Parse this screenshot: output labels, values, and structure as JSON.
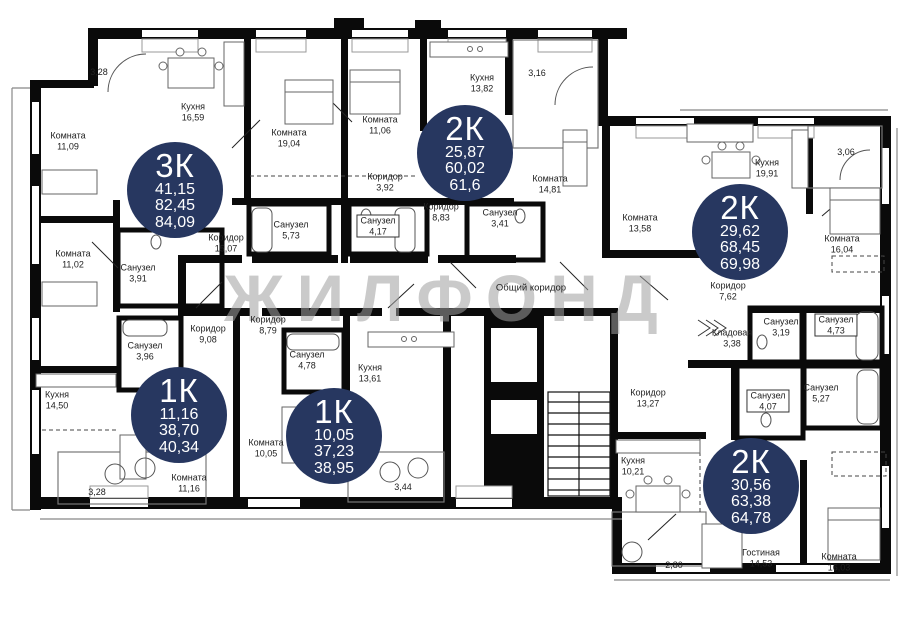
{
  "watermark": {
    "text": "ЖИЛФОНД"
  },
  "corridor_label": "Общий коридор",
  "badges": [
    {
      "type": "3К",
      "values": [
        "41,15",
        "82,45",
        "84,09"
      ]
    },
    {
      "type": "2К",
      "values": [
        "25,87",
        "60,02",
        "61,6"
      ]
    },
    {
      "type": "2К",
      "values": [
        "29,62",
        "68,45",
        "69,98"
      ]
    },
    {
      "type": "1К",
      "values": [
        "11,16",
        "38,70",
        "40,34"
      ]
    },
    {
      "type": "1К",
      "values": [
        "10,05",
        "37,23",
        "38,95"
      ]
    },
    {
      "type": "2К",
      "values": [
        "30,56",
        "63,38",
        "64,78"
      ]
    }
  ],
  "rooms": [
    {
      "name": "Комната",
      "area": "11,09"
    },
    {
      "name": "Кухня",
      "area": "16,59"
    },
    {
      "name": "Комната",
      "area": "19,04"
    },
    {
      "name": "Комната",
      "area": "11,06"
    },
    {
      "name": "Коридор",
      "area": "3,92"
    },
    {
      "name": "Кухня",
      "area": "13,82"
    },
    {
      "name": "Комната",
      "area": "14,81"
    },
    {
      "name": "Коридор",
      "area": "8,83"
    },
    {
      "name": "Санузел",
      "area": "5,73"
    },
    {
      "name": "Санузел",
      "area": "4,17"
    },
    {
      "name": "Санузел",
      "area": "3,41"
    },
    {
      "name": "Комната",
      "area": "13,58"
    },
    {
      "name": "Кухня",
      "area": "19,91"
    },
    {
      "name": "Комната",
      "area": "16,04"
    },
    {
      "name": "Коридор",
      "area": "7,62"
    },
    {
      "name": "Комната",
      "area": "11,02"
    },
    {
      "name": "Санузел",
      "area": "3,91"
    },
    {
      "name": "Коридор",
      "area": "15,07"
    },
    {
      "name": "Санузел",
      "area": "3,96"
    },
    {
      "name": "Коридор",
      "area": "9,08"
    },
    {
      "name": "Кухня",
      "area": "14,50"
    },
    {
      "name": "Коридор",
      "area": "8,79"
    },
    {
      "name": "Санузел",
      "area": "4,78"
    },
    {
      "name": "Кухня",
      "area": "13,61"
    },
    {
      "name": "Комната",
      "area": "10,05"
    },
    {
      "name": "Комната",
      "area": "11,16"
    },
    {
      "name": "Кладовая",
      "area": "3,38"
    },
    {
      "name": "Санузел",
      "area": "3,19"
    },
    {
      "name": "Санузел",
      "area": "4,73"
    },
    {
      "name": "Санузел",
      "area": "4,07"
    },
    {
      "name": "Санузел",
      "area": "5,27"
    },
    {
      "name": "Коридор",
      "area": "13,27"
    },
    {
      "name": "Кухня",
      "area": "10,21"
    },
    {
      "name": "Гостиная",
      "area": "14,53"
    },
    {
      "name": "Комната",
      "area": "16,03"
    }
  ],
  "balconies": [
    {
      "area": "3,28"
    },
    {
      "area": "3,16"
    },
    {
      "area": "3,06"
    },
    {
      "area": "3,28"
    },
    {
      "area": "3,44"
    },
    {
      "area": "2,80"
    }
  ],
  "colors": {
    "badge_bg": "#273760",
    "wall": "#0a0a0a",
    "watermark": "#a0a0a0"
  }
}
